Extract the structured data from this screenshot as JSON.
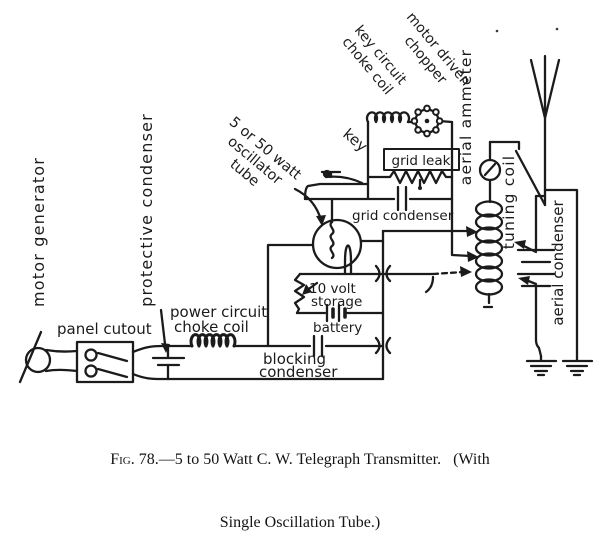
{
  "colors": {
    "ink": "#1b1b1b",
    "paper": "#ffffff"
  },
  "caption": {
    "fig_label": "Fig.",
    "line1_rest": " 78.—5 to 50 Watt C. W. Telegraph Transmitter.   (With",
    "line2": "Single Oscillation Tube.)"
  },
  "labels": {
    "motor_generator": "motor generator",
    "protective_condenser": "protective condenser",
    "panel_cutout": "panel cutout",
    "power_choke": [
      "power circuit",
      "choke coil"
    ],
    "blocking_condenser": [
      "blocking",
      "condenser"
    ],
    "oscillator_tube": [
      "5 or 50 watt",
      "oscillator",
      "tube"
    ],
    "key": "key",
    "key_choke": [
      "key circuit",
      "choke coil"
    ],
    "chopper": [
      "motor driven",
      "chopper"
    ],
    "grid_leak": "grid leak",
    "grid_condenser": "grid condenser",
    "aerial_ammeter": "aerial ammeter",
    "tuning_coil": "tuning coil",
    "aerial_condenser": "aerial condenser",
    "storage_battery": [
      "10 volt",
      "storage",
      "battery"
    ]
  }
}
